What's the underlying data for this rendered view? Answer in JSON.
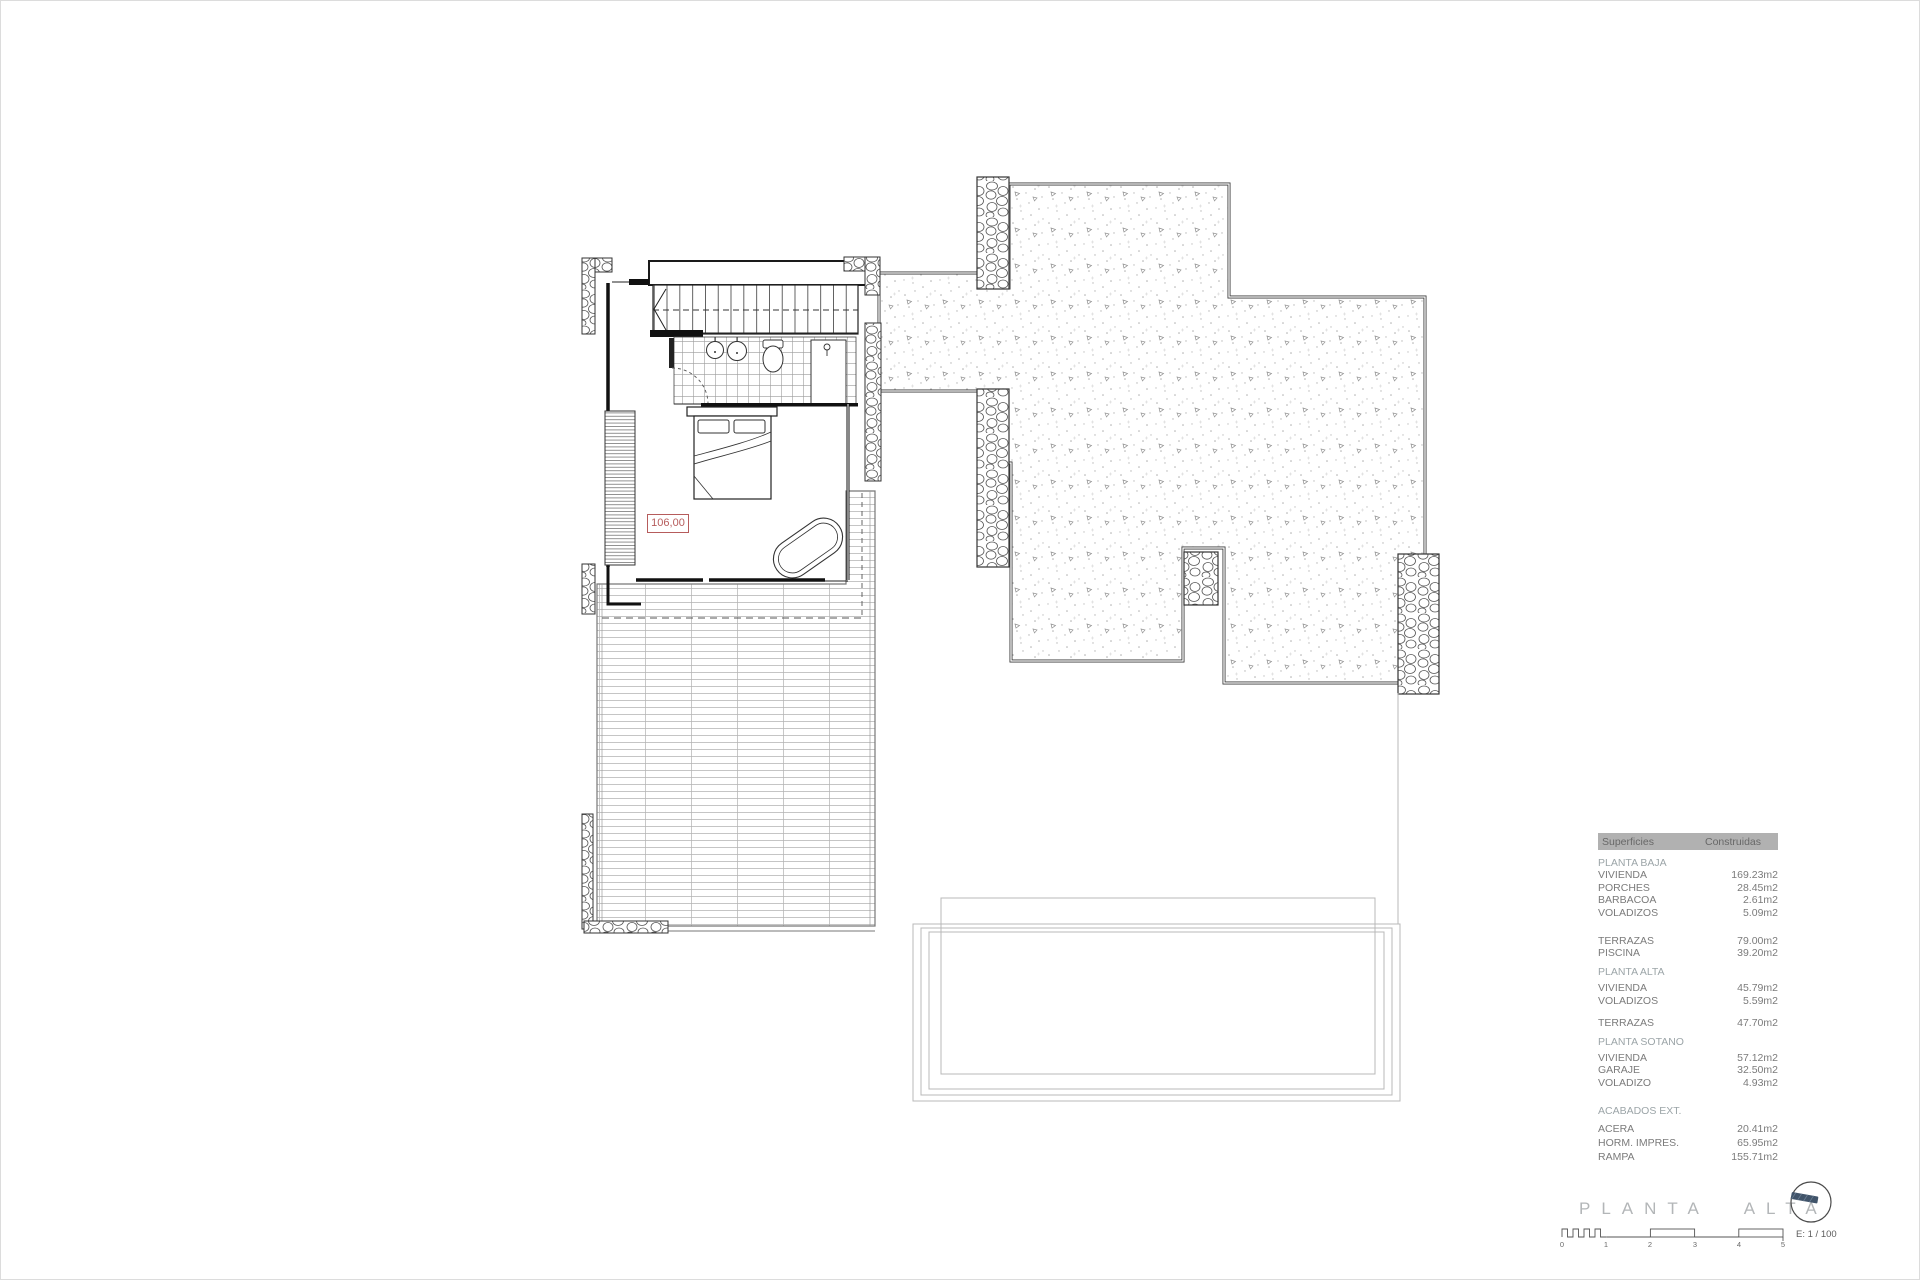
{
  "drawing": {
    "title": "PLANTA ALTA",
    "area_label": "106,00",
    "scale_label": "E: 1 / 100",
    "scale_ticks": [
      "0",
      "1",
      "2",
      "3",
      "4",
      "5"
    ]
  },
  "table": {
    "header": {
      "col1": "Superficies",
      "col2": "Construidas"
    },
    "rows": [
      {
        "label": "PLANTA BAJA",
        "value": ""
      },
      {
        "label": "VIVIENDA",
        "value": "169.23m2"
      },
      {
        "label": "PORCHES",
        "value": "28.45m2"
      },
      {
        "label": "BARBACOA",
        "value": "2.61m2"
      },
      {
        "label": "VOLADIZOS",
        "value": "5.09m2"
      },
      {
        "label": "TERRAZAS",
        "value": "79.00m2"
      },
      {
        "label": "PISCINA",
        "value": "39.20m2"
      },
      {
        "label": "PLANTA ALTA",
        "value": ""
      },
      {
        "label": "VIVIENDA",
        "value": "45.79m2"
      },
      {
        "label": "VOLADIZOS",
        "value": "5.59m2"
      },
      {
        "label": "TERRAZAS",
        "value": "47.70m2"
      },
      {
        "label": "PLANTA SOTANO",
        "value": ""
      },
      {
        "label": "VIVIENDA",
        "value": "57.12m2"
      },
      {
        "label": "GARAJE",
        "value": "32.50m2"
      },
      {
        "label": "VOLADIZO",
        "value": "4.93m2"
      },
      {
        "label": "ACABADOS EXT.",
        "value": ""
      },
      {
        "label": "ACERA",
        "value": "20.41m2"
      },
      {
        "label": "HORM. IMPRES.",
        "value": "65.95m2"
      },
      {
        "label": "RAMPA",
        "value": "155.71m2"
      }
    ]
  },
  "colors": {
    "accent_red": "#b65c5c",
    "table_header_bg": "#b1b1b1",
    "section_text": "#9ca5a8",
    "row_text": "#7b7b7b",
    "title_text": "#b3b6b8",
    "compass_arrow": "#41546a"
  }
}
